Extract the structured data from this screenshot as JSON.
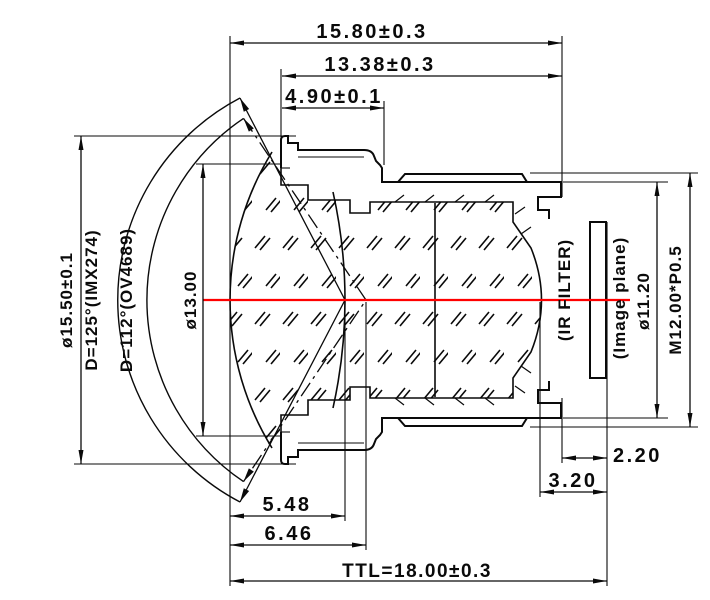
{
  "drawing": {
    "kind": "lens cross-section mechanical drawing",
    "colors": {
      "line": "#0a0a0a",
      "optical_axis": "#ff0000",
      "background": "#ffffff"
    },
    "dims": {
      "total_width": "15.80±0.3",
      "barrel_width": "13.38±0.3",
      "flange_width": "4.90±0.1",
      "dome_diameter": "ø15.50±0.1",
      "fov_imx274": "D=125°(IMX274)",
      "fov_ov4689": "D=112°(OV4689)",
      "clear_aperture": "ø13.00",
      "ir_filter": "(IR FILTER)",
      "image_plane": "(Image plane)",
      "image_circle": "ø11.20",
      "thread": "M12.00*P0.5",
      "filter_to_image": "2.20",
      "rear_vertex_to_image": "3.20",
      "pupil_125": "5.48",
      "pupil_112": "6.46",
      "ttl": "TTL=18.00±0.3"
    }
  }
}
